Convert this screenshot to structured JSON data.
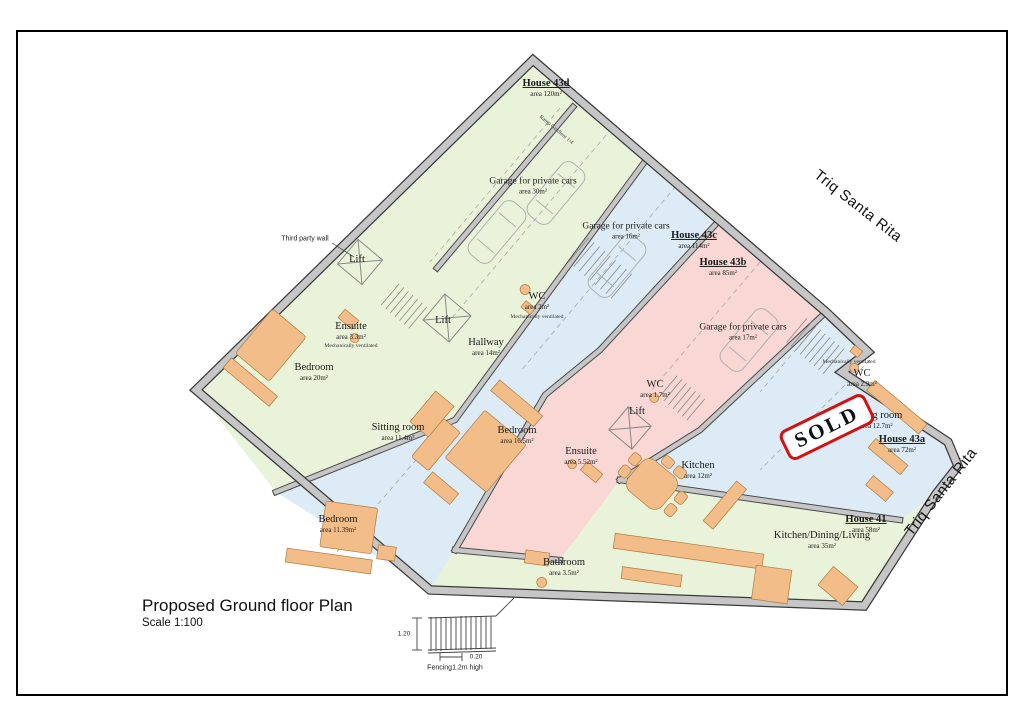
{
  "title_block": {
    "title": "Proposed Ground floor Plan",
    "scale": "Scale 1:100"
  },
  "streets": {
    "upper": "Triq Santa Rita",
    "lower": "Triq Santa Rita"
  },
  "sold_stamp": "SOLD",
  "annotations": {
    "third_party_wall": "Third party wall",
    "ramp": "Ramp Gradient 1:4",
    "mech_vent": "Mechanically ventilated"
  },
  "fence_legend": {
    "height_dim": "1.20",
    "spacing_dim": "0.20",
    "caption": "Fencing1.2m high"
  },
  "houses": [
    {
      "name": "House 43d",
      "area": "area 120m²"
    },
    {
      "name": "House 43c",
      "area": "area 114m²"
    },
    {
      "name": "House 43b",
      "area": "area 85m²"
    },
    {
      "name": "House 43a",
      "area": "area 72m²"
    },
    {
      "name": "House 41",
      "area": "area 58m²"
    }
  ],
  "rooms": [
    {
      "label": "Lift",
      "area": ""
    },
    {
      "label": "Ensuite",
      "area": "area 3.3m²"
    },
    {
      "label": "Bedroom",
      "area": "area 20m²"
    },
    {
      "label": "WC",
      "area": "area 2m²"
    },
    {
      "label": "Lift",
      "area": ""
    },
    {
      "label": "Hallway",
      "area": "area 14m²"
    },
    {
      "label": "Garage for private cars",
      "area": "area 30m²"
    },
    {
      "label": "Garage for private cars",
      "area": "area 16m²"
    },
    {
      "label": "Garage for private cars",
      "area": "area 17m²"
    },
    {
      "label": "WC",
      "area": "area 2.9m²"
    },
    {
      "label": "Living room",
      "area": "area 12.7m²"
    },
    {
      "label": "Sitting room",
      "area": "area 11.4m²"
    },
    {
      "label": "Bedroom",
      "area": "area 16.5m²"
    },
    {
      "label": "WC",
      "area": "area 1.7m²"
    },
    {
      "label": "Lift",
      "area": ""
    },
    {
      "label": "Ensuite",
      "area": "area 5.52m²"
    },
    {
      "label": "Kitchen",
      "area": "area 12m²"
    },
    {
      "label": "Bedroom",
      "area": "area 11.39m²"
    },
    {
      "label": "Bathroom",
      "area": "area 3.5m²"
    },
    {
      "label": "Kitchen/Dining/Living",
      "area": "area 35m²"
    }
  ],
  "colors": {
    "house_green": "#e9f3d9",
    "house_blue": "#dcebf5",
    "house_pink": "#f8d7d4",
    "wall_gray": "#c6c6c6",
    "furniture_orange": "#f2bd88",
    "sold_red": "#d01212"
  }
}
